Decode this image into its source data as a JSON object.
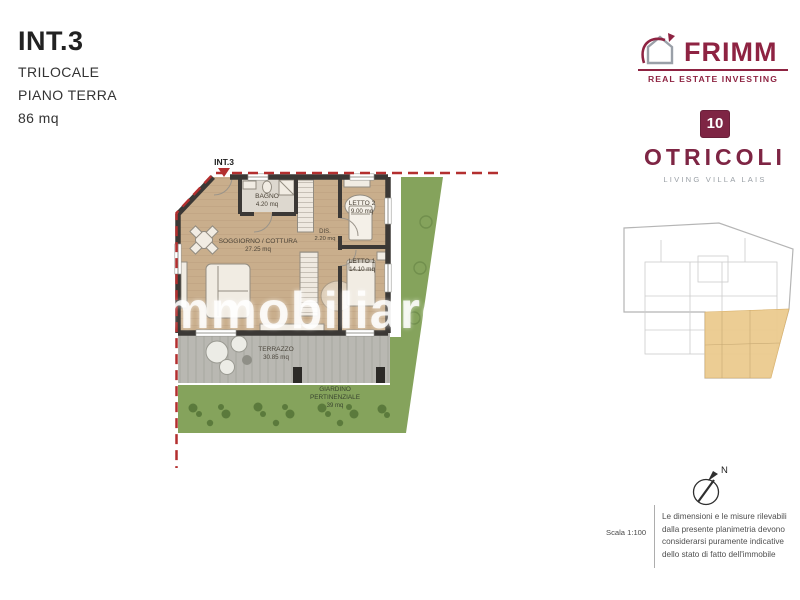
{
  "header": {
    "unit": "INT.3",
    "type": "TRILOCALE",
    "floor": "PIANO TERRA",
    "area": "86 mq"
  },
  "frimm": {
    "name": "FRIMM",
    "tagline": "REAL ESTATE INVESTING",
    "brand_color": "#8e2342"
  },
  "project": {
    "number": "10",
    "name": "OTRICOLI",
    "subtitle": "LIVING VILLA LAIS",
    "brand_color": "#7e2544"
  },
  "plan": {
    "unit_label": "INT.3",
    "rooms": [
      {
        "name": "BAGNO",
        "area": "4.20 mq"
      },
      {
        "name": "LETTO 2",
        "area": "9.00 mq"
      },
      {
        "name": "SOGGIORNO / COTTURA",
        "area": "27.25 mq"
      },
      {
        "name": "DIS.",
        "area": "2.20 mq"
      },
      {
        "name": "LETTO 1",
        "area": "14.10 mq"
      },
      {
        "name": "TERRAZZO",
        "area": "30.85 mq"
      }
    ],
    "garden": {
      "line1": "GIARDINO",
      "line2": "PERTINENZIALE",
      "area": "39 mq"
    },
    "colors": {
      "wall": "#3b3835",
      "floor": "#c9ae8c",
      "terrace": "#b9b8b2",
      "garden": "#85a35c",
      "boundary": "#b32f2f",
      "keyplan_highlight": "#ebca8e"
    }
  },
  "watermark": "immobiliare.it",
  "footer": {
    "scale": "Scala 1:100",
    "compass": "N",
    "disclaimer_lines": [
      "Le dimensioni e le misure rilevabili",
      "dalla presente planimetria devono",
      "considerarsi puramente indicative",
      "dello stato di fatto dell'immobile"
    ]
  }
}
